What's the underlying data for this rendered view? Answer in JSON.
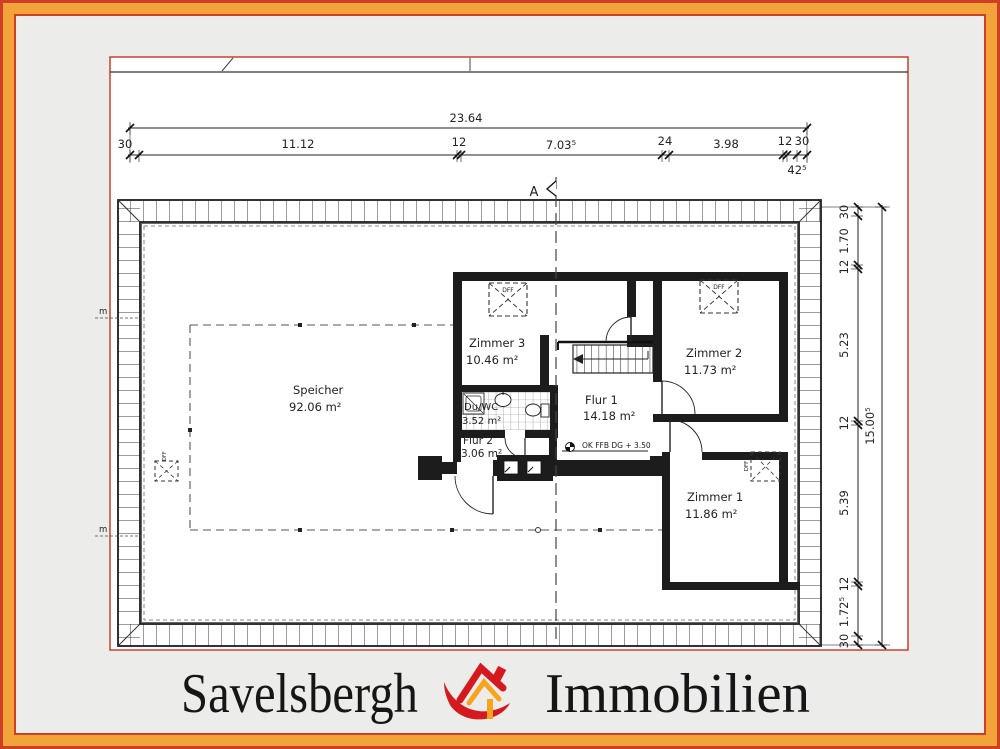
{
  "colors": {
    "frame_orange": "#f2a339",
    "frame_red": "#ce3f28",
    "sheet_border_red": "#c8402a",
    "wall_black": "#1c1c1c",
    "logo_red": "#d41a1f",
    "logo_yellow": "#f6a41d"
  },
  "brand": {
    "left": "Savelsbergh",
    "right": "Immobilien"
  },
  "plan": {
    "section_label": "A",
    "level_note": "OK FFB DG + 3.50",
    "roof_window_label": "DFF",
    "meter_line_label": "m",
    "rooms": {
      "speicher": {
        "name": "Speicher",
        "area": "92.06 m²"
      },
      "zimmer1": {
        "name": "Zimmer 1",
        "area": "11.86 m²"
      },
      "zimmer2": {
        "name": "Zimmer 2",
        "area": "11.73 m²"
      },
      "zimmer3": {
        "name": "Zimmer 3",
        "area": "10.46 m²"
      },
      "flur1": {
        "name": "Flur 1",
        "area": "14.18 m²"
      },
      "flur2": {
        "name": "Flur 2",
        "area": "3.06 m²"
      },
      "duwc": {
        "name": "Du/WC",
        "area": "3.52 m²"
      }
    },
    "dimensions": {
      "top_total": "23.64",
      "top_chain": [
        "30",
        "11.12",
        "12",
        "7.03⁵",
        "24",
        "3.98",
        "12",
        "30"
      ],
      "top_sub": "42⁵",
      "right_total": "15.00⁵",
      "right_chain": [
        "30",
        "1.70",
        "12",
        "5.23",
        "12",
        "5.39",
        "12",
        "1.72⁵",
        "30"
      ]
    }
  }
}
